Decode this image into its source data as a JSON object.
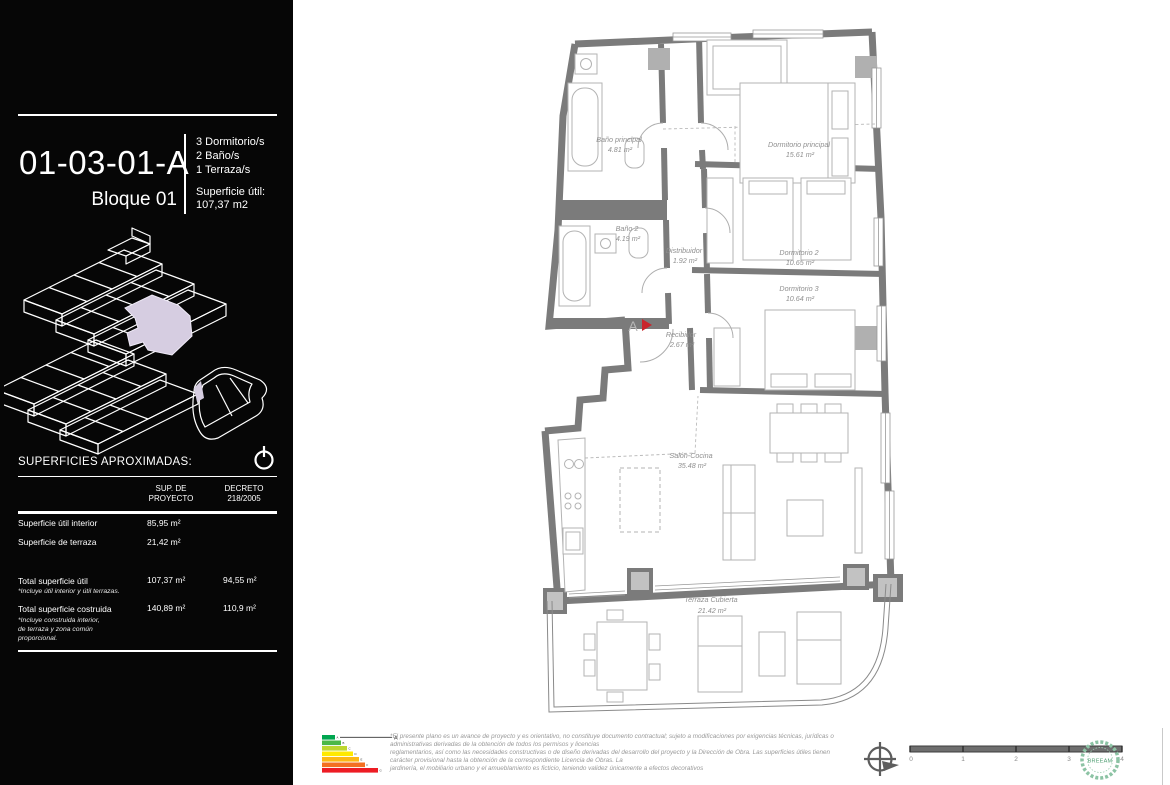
{
  "sidebar": {
    "unit_code": "01-03-01-A",
    "block": "Bloque 01",
    "features": [
      "3 Dormitorio/s",
      "2 Baño/s",
      "1 Terraza/s"
    ],
    "surface_label": "Superficie útil:",
    "surface_value": "107,37  m2",
    "surfaces_heading": "SUPERFICIES APROXIMADAS:",
    "table": {
      "col1_line1": "SUP. DE",
      "col1_line2": "PROYECTO",
      "col2_line1": "DECRETO",
      "col2_line2": "218/2005",
      "rows": [
        {
          "label": "Superficie útil interior",
          "proyecto": "85,95  m²",
          "decreto": ""
        },
        {
          "label": "Superficie de terraza",
          "proyecto": "21,42  m²",
          "decreto": ""
        },
        {
          "label": "Total superficie útil",
          "note": "*Incluye útil interior y útil terrazas.",
          "proyecto": "107,37  m²",
          "decreto": "94,55  m²"
        },
        {
          "label": "Total superficie costruida",
          "note_lines": [
            "*Incluye construida interior,",
            "de terraza y zona común",
            "proporcional."
          ],
          "proyecto": "140,89  m²",
          "decreto": "110,9  m²"
        }
      ]
    }
  },
  "floor_plan": {
    "entrance_marker": "A",
    "rooms": [
      {
        "name": "Baño principal",
        "area": "4.81 m²"
      },
      {
        "name": "Dormitorio principal",
        "area": "15.61 m²"
      },
      {
        "name": "Baño 2",
        "area": "4.19 m²"
      },
      {
        "name": "Distribuidor",
        "area": "1.92 m²"
      },
      {
        "name": "Dormitorio 2",
        "area": "10.65 m²"
      },
      {
        "name": "Dormitorio 3",
        "area": "10.64 m²"
      },
      {
        "name": "Recibidor",
        "area": "2.67 m²"
      },
      {
        "name": "Salón-Cocina",
        "area": "35.48 m²"
      },
      {
        "name": "Terraza Cubierta",
        "area": "21.42 m²"
      }
    ]
  },
  "footer": {
    "energy": {
      "rating": "A",
      "letters": [
        "A",
        "B",
        "C",
        "D",
        "E",
        "F",
        "G"
      ],
      "colors": [
        "#00a650",
        "#4cb847",
        "#bed62f",
        "#ffe900",
        "#fcb814",
        "#f36f21",
        "#ed1c24"
      ]
    },
    "disclaimer_lines": [
      "*El presente plano es un avance de proyecto y es orientativo, no constituye documento contractual; sujeto a modificaciones por exigencias técnicas, jurídicas o",
      "administrativas derivadas de la obtención de todos los permisos y licencias",
      "reglamentarios, así como las necesidades constructivas o de diseño derivadas del desarrollo del proyecto y la Dirección de Obra. Las superficies útiles tienen",
      "carácter provisional hasta la obtención de la correspondiente Licencia de Obras. La",
      "jardinería, el mobiliario urbano y el amueblamiento es ficticio, teniendo validez únicamente a efectos decorativos"
    ],
    "scale_ticks": [
      "0",
      "1",
      "2",
      "3",
      "4"
    ],
    "breeam_label": "BREEAM"
  },
  "colors": {
    "highlight_lavender": "#d6cde1",
    "wall_gray": "#7b7b7b",
    "entrance_red": "#c9252c",
    "breeam_green": "#6fae8c"
  }
}
